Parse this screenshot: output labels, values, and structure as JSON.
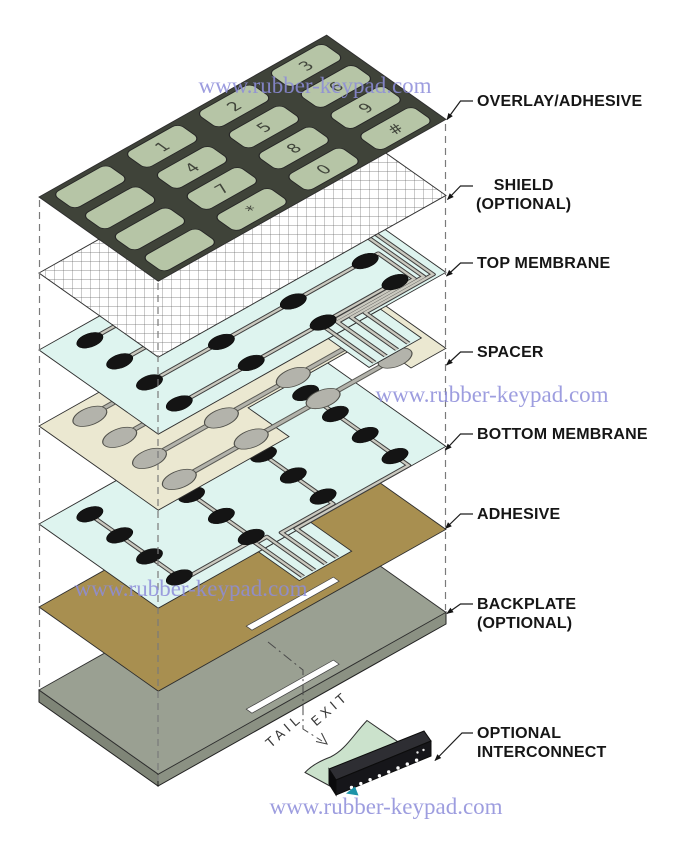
{
  "watermark": {
    "text": "www.rubber-keypad.com"
  },
  "layer_labels": {
    "overlay": "OVERLAY/ADHESIVE",
    "shield": "SHIELD\n(OPTIONAL)",
    "top_membrane": "TOP MEMBRANE",
    "spacer": "SPACER",
    "bottom_membrane": "BOTTOM MEMBRANE",
    "adhesive": "ADHESIVE",
    "backplate": "BACKPLATE\n(OPTIONAL)",
    "interconnect": "OPTIONAL\nINTERCONNECT"
  },
  "annotations": {
    "tail": "TAIL",
    "exit": "EXIT"
  },
  "keypad": {
    "keys": [
      "",
      "",
      "",
      "",
      "1",
      "4",
      "7",
      "*",
      "2",
      "5",
      "8",
      "0",
      "3",
      "6",
      "9",
      "#"
    ]
  },
  "colors": {
    "overlay": "#3f4339",
    "key": "#b6c5a6",
    "membrane": "#def4ef",
    "spacer": "#ebe8d1",
    "spacer_hole": "#b3b3ab",
    "adhesive": "#a88f50",
    "backplate": "#9aa092",
    "backplate_side": "#82887a",
    "trace": "#cac9bf",
    "contact": "#141414",
    "connector": "#16161a",
    "connector_tail": "#cbe2cc",
    "accent_teal": "#1d93a8",
    "watermark_blue": "#8d8dda",
    "label_text": "#161616"
  }
}
